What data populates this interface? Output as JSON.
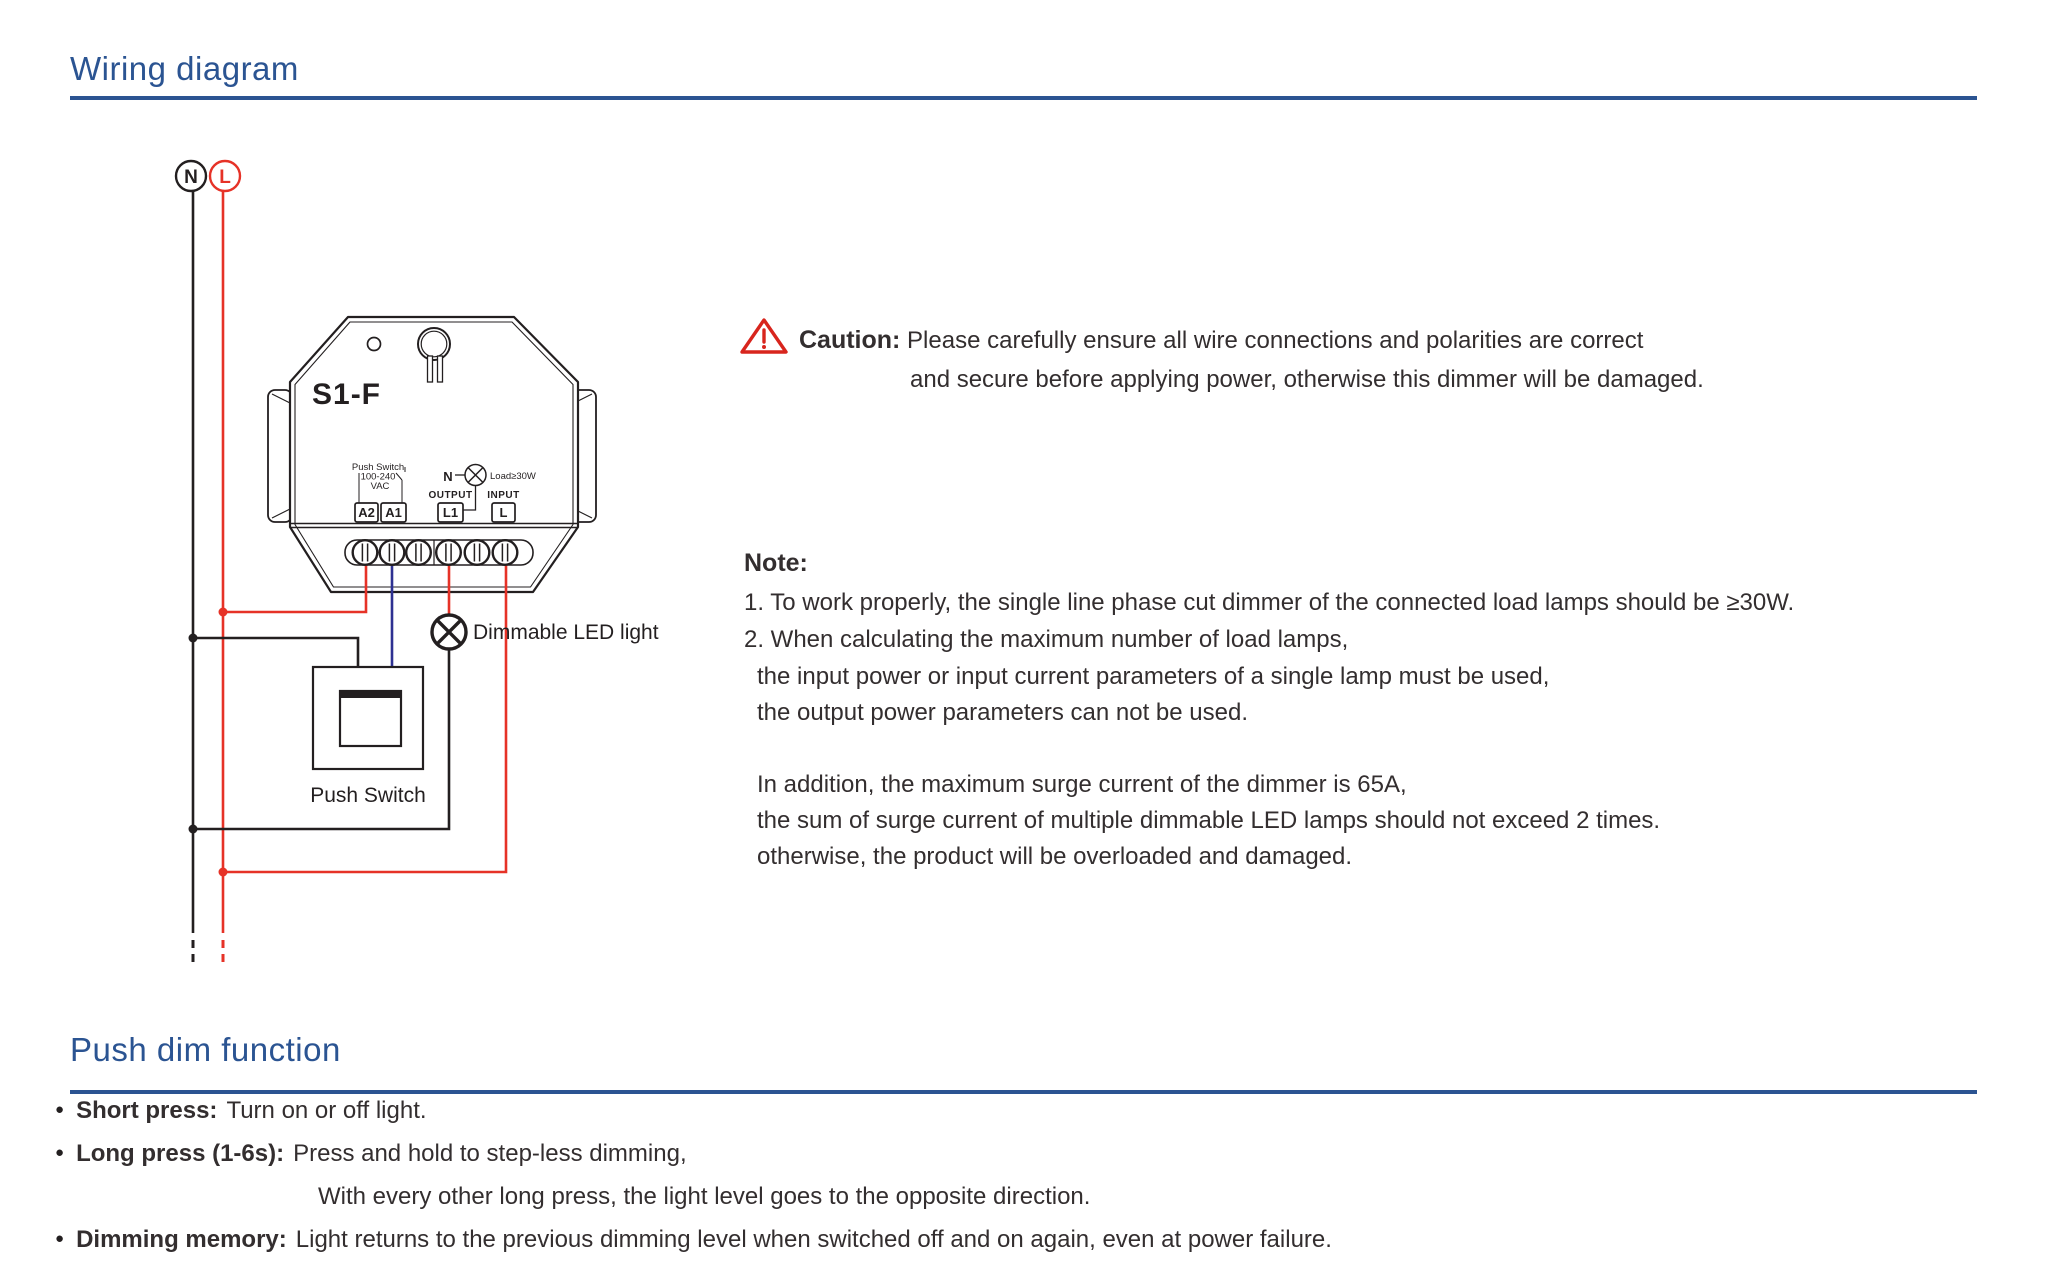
{
  "colors": {
    "accent-blue": "#2b5492",
    "ink": "#231f20",
    "text": "#332e2f",
    "wire-red": "#e63227",
    "wire-blue": "#2e3192",
    "caution-red": "#d8251d"
  },
  "sections": {
    "wiring_title": "Wiring diagram",
    "push_dim_title": "Push dim function"
  },
  "diagram": {
    "supply": {
      "neutral": "N",
      "live": "L"
    },
    "device": {
      "model": "S1-F",
      "push_switch_small": "Push Switch",
      "voltage": "100-240",
      "vac": "VAC",
      "n_label": "N",
      "load_label": "Load≥30W",
      "output_label": "OUTPUT",
      "input_label": "INPUT",
      "terminal_a2": "A2",
      "terminal_a1": "A1",
      "terminal_l1": "L1",
      "terminal_l": "L"
    },
    "push_switch_label": "Push Switch",
    "led_light_label": "Dimmable LED light"
  },
  "caution": {
    "label": "Caution:",
    "line1": "Please carefully ensure all wire connections and polarities are correct",
    "line2": "and secure before applying power, otherwise this dimmer will be damaged."
  },
  "note": {
    "label": "Note:",
    "lines": [
      "1. To work properly, the single line phase cut dimmer of the connected load lamps should be ≥30W.",
      "2. When calculating the maximum number of load lamps,",
      "the input power or input current parameters of a single lamp must be used,",
      "the output power parameters can not be used.",
      "In addition, the maximum surge current of the dimmer is 65A,",
      "the sum of surge current of multiple dimmable LED lamps should not exceed 2 times.",
      "otherwise, the product will be overloaded and damaged."
    ]
  },
  "push_dim": {
    "bullet_char": "●",
    "bullets": [
      {
        "label": "Short press:",
        "text": "Turn on or off light."
      },
      {
        "label": "Long press (1-6s):",
        "text": "Press and hold to step-less dimming,",
        "cont": "With every other long press, the light level goes to the opposite direction."
      },
      {
        "label": "Dimming memory:",
        "text": "Light returns to the previous dimming level when switched off and on again, even at power failure."
      }
    ]
  }
}
